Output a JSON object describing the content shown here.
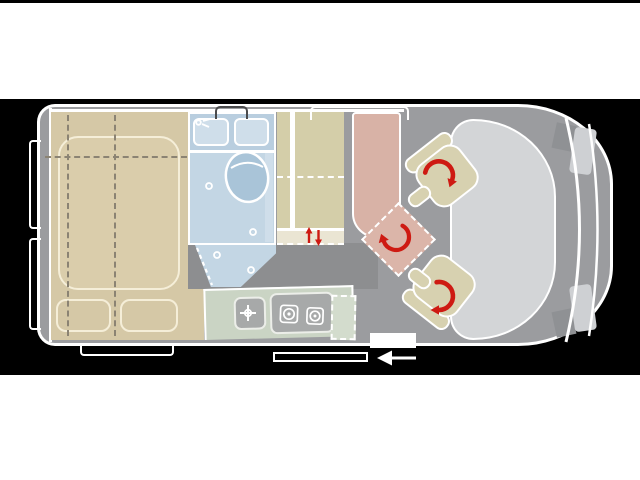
{
  "title": "campervan-floorplan-top-view",
  "colors": {
    "white": "#ffffff",
    "black": "#000000",
    "floor": "#9b9c9f",
    "floorDark": "#8d8e90",
    "bedTan": "#d5c8a6",
    "mattress": "#dacdab",
    "cream": "#f5eed8",
    "dashBrown": "#8b8373",
    "bathBlue": "#c3d6e4",
    "bathPanel": "#b9cedf",
    "bathBox": "#cfdeea",
    "toiletBlue": "#a9c4d8",
    "wardrobeKhaki": "#d4cea9",
    "wardrobeStrip": "#eae5d3",
    "kitchenSage": "#cad4c4",
    "kitchenDashed": "#d3dccd",
    "unitGray": "#a7a9a9",
    "unitLine": "#eceee9",
    "salmon": "#d8b2a6",
    "tableSalmon": "#dbb5a9",
    "seatKhaki": "#d7d1b0",
    "hoodGray": "#d3d5d7",
    "lightPatch": "#ced0d3",
    "pillarGray": "#8f9194",
    "arrowRed": "#ce1a12",
    "bracketDark": "#4a4a4c"
  },
  "icons": [
    "rotation-arrow-icon",
    "up-down-arrow-icon",
    "exit-arrow-icon",
    "faucet-icon",
    "sink-crosshair-icon",
    "stove-burner-icon",
    "toilet-icon",
    "shower-drain-icon",
    "window-bracket-icon",
    "door-outline-icon"
  ],
  "regions": {
    "bed": "rear-bed",
    "bathroom": "bathroom-with-toilet-and-sink",
    "wardrobe": "wardrobe-cabinet",
    "kitchen": "kitchenette-sink-and-two-burner-stove",
    "bench": "bench-seat",
    "table": "swivel-table",
    "seats": "two-swivel-cab-seats",
    "cab": "driver-cab-front"
  },
  "counts": {
    "swivel_seats": 2,
    "stove_burners": 2,
    "rotation_arrows": 3,
    "rear_door_brackets": 2
  }
}
